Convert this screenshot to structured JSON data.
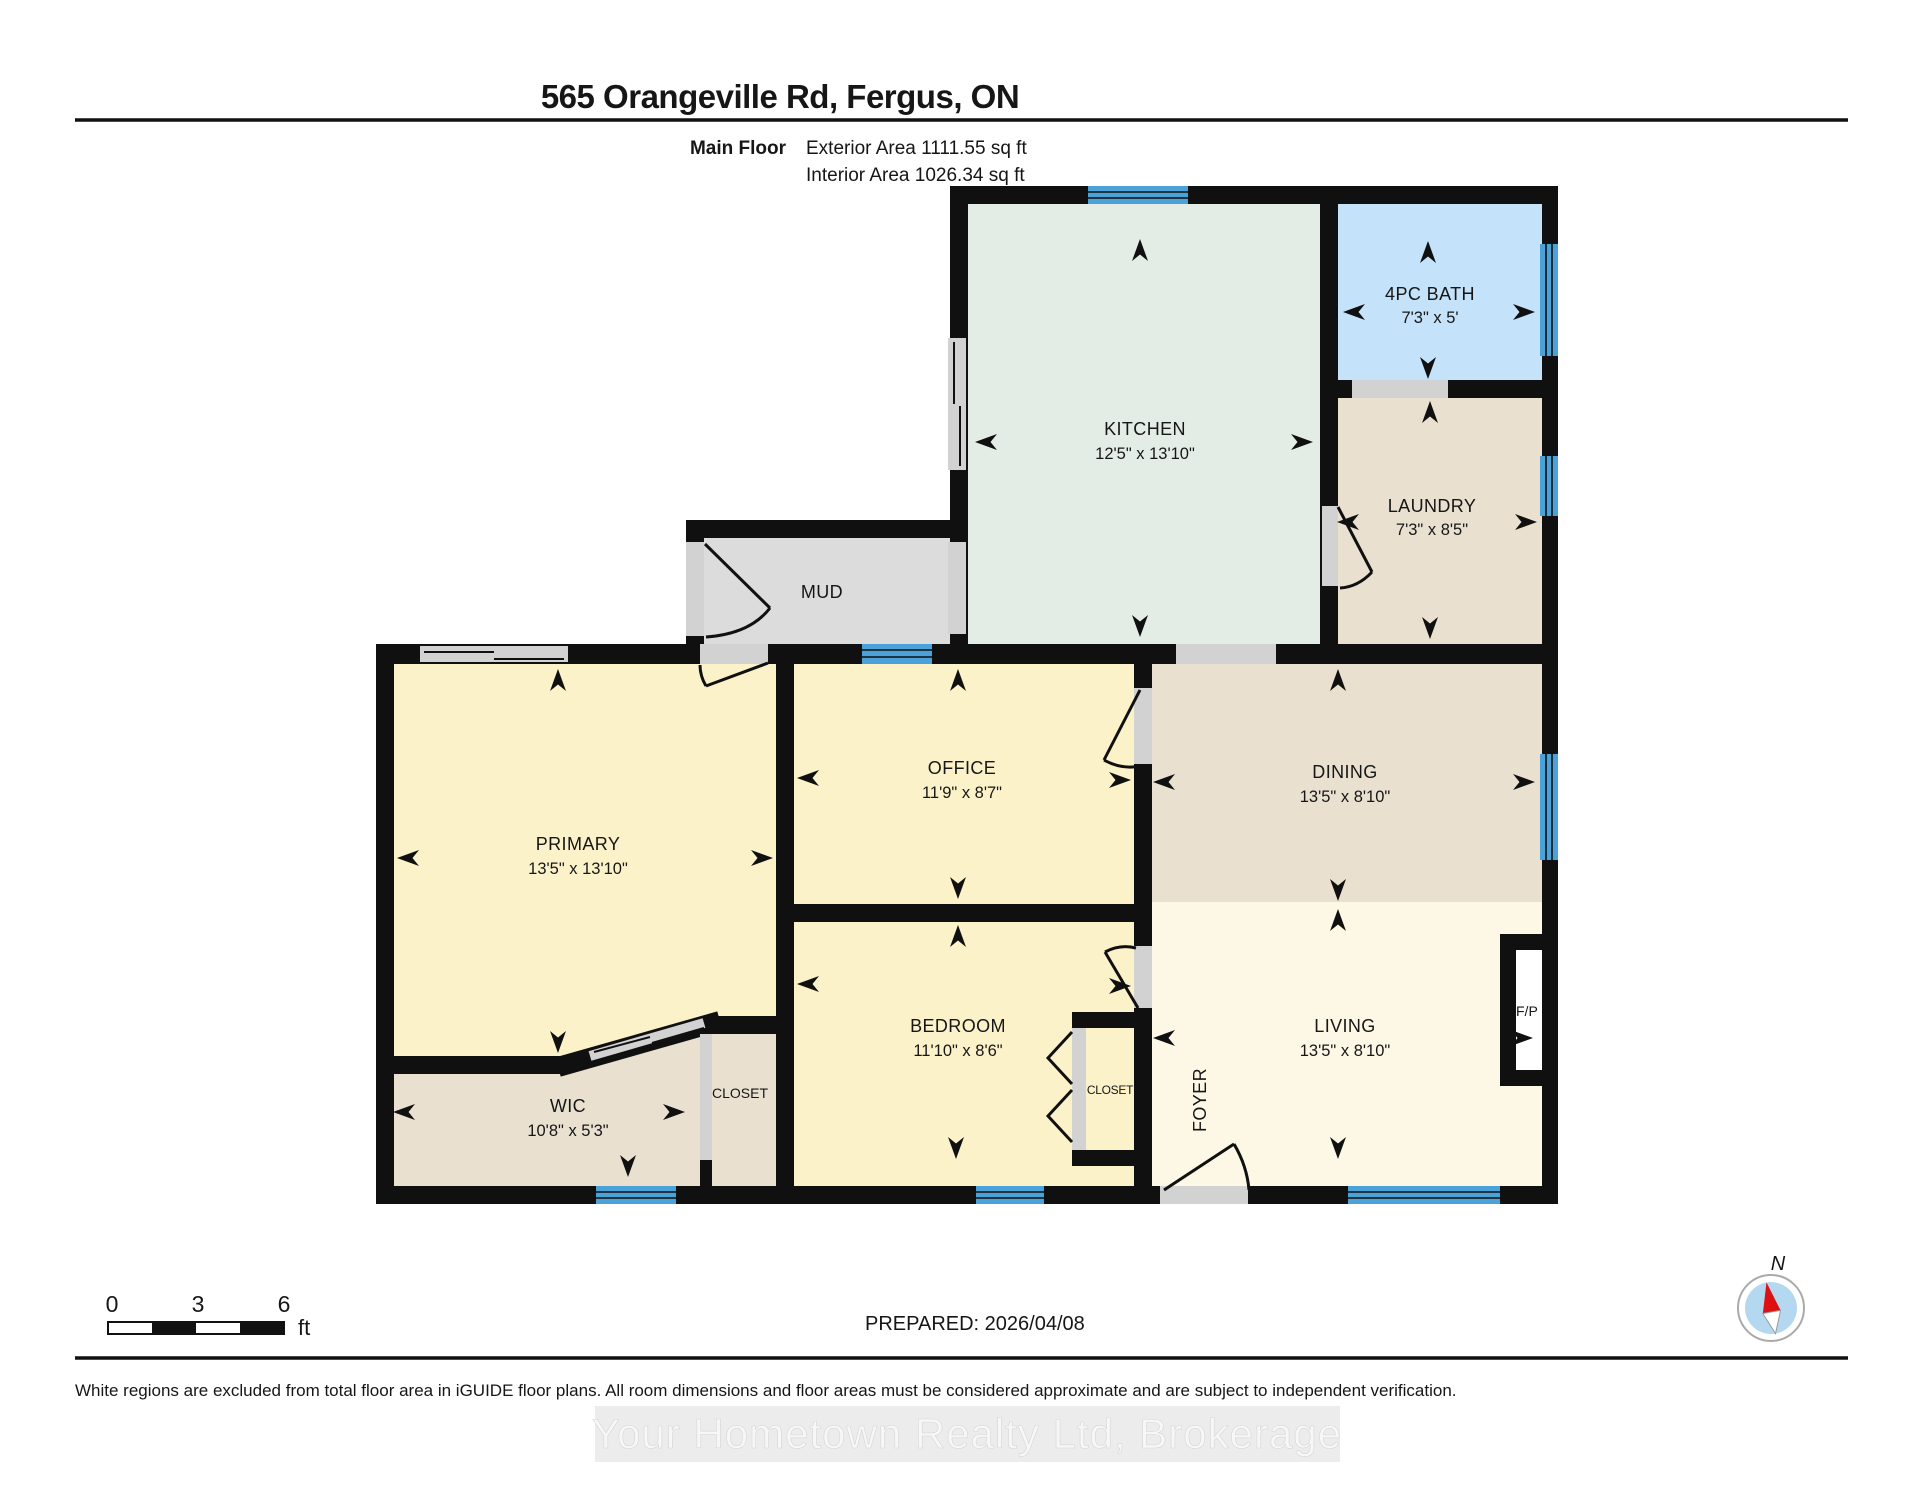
{
  "header": {
    "title": "565 Orangeville Rd, Fergus, ON",
    "floor_label": "Main Floor",
    "exterior_area": "Exterior Area 1111.55 sq ft",
    "interior_area": "Interior Area 1026.34 sq ft"
  },
  "rooms": {
    "kitchen": {
      "name": "KITCHEN",
      "dims": "12'5\" x 13'10\""
    },
    "bath": {
      "name": "4PC BATH",
      "dims": "7'3\" x 5'"
    },
    "laundry": {
      "name": "LAUNDRY",
      "dims": "7'3\" x 8'5\""
    },
    "mud": {
      "name": "MUD"
    },
    "primary": {
      "name": "PRIMARY",
      "dims": "13'5\" x 13'10\""
    },
    "office": {
      "name": "OFFICE",
      "dims": "11'9\" x 8'7\""
    },
    "dining": {
      "name": "DINING",
      "dims": "13'5\" x 8'10\""
    },
    "bedroom": {
      "name": "BEDROOM",
      "dims": "11'10\" x 8'6\""
    },
    "living": {
      "name": "LIVING",
      "dims": "13'5\" x 8'10\""
    },
    "wic": {
      "name": "WIC",
      "dims": "10'8\" x 5'3\""
    },
    "closet_primary": {
      "name": "CLOSET"
    },
    "closet_bedroom": {
      "name": "CLOSET"
    },
    "foyer": {
      "name": "FOYER"
    },
    "fireplace": {
      "name": "F/P"
    }
  },
  "scale_bar": {
    "tick_start": "0",
    "tick_mid": "3",
    "tick_end": "6",
    "unit": "ft"
  },
  "compass": {
    "label": "N"
  },
  "footer": {
    "prepared": "PREPARED: 2026/04/08",
    "disclaimer": "White regions are excluded from total floor area in iGUIDE floor plans. All room dimensions and floor areas must be considered approximate and are subject to independent verification.",
    "watermark": "Your Hometown Realty Ltd, Brokerage"
  },
  "colors": {
    "wall": "#101010",
    "kitchen": "#e3ede5",
    "bath": "#c4e2f9",
    "beige": "#e9e0d0",
    "yellow": "#fcf2ca",
    "cream": "#fdf8e5",
    "mud": "#dcdcdc",
    "window": "#4aa2d9",
    "opening": "#d2d2d2"
  }
}
